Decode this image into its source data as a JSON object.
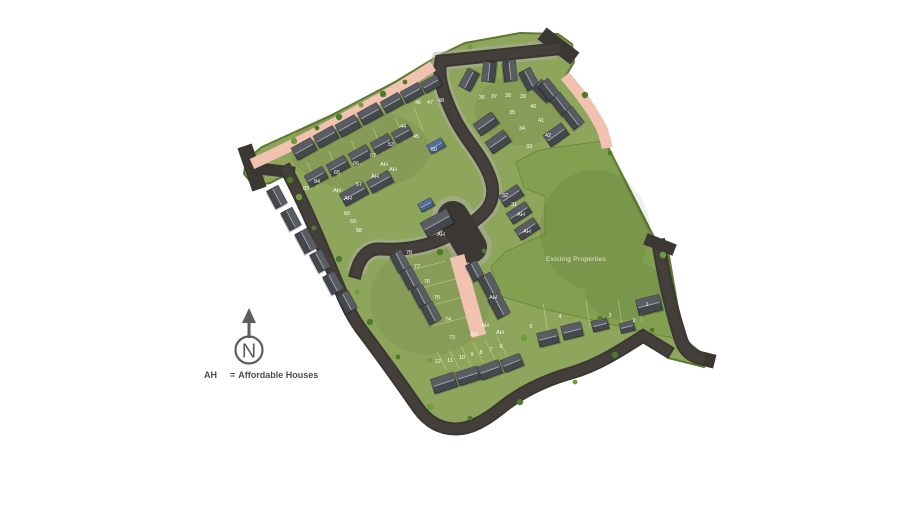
{
  "page": {
    "background": "#ffffff"
  },
  "legend": {
    "ah": "AH",
    "eq": "=",
    "text": "Affordable Houses"
  },
  "compass": {
    "letter": "N"
  },
  "map": {
    "field_label": "Existing Properties",
    "colors": {
      "background": "#ffffff",
      "road": "#3b3733",
      "road_inner": "#443f3a",
      "sidewalk": "#b2afa4",
      "grass": "#8ea55c",
      "field": "#82a050",
      "hedge": "#5d7a33",
      "pink_path": "#f2c2b1",
      "roof": "#44474c",
      "roof_light": "#5d6167",
      "ridge": "#a9aeb4",
      "label_text": "#ffffff",
      "legend_text": "#4c4c4c"
    },
    "plot_labels": [
      {
        "t": "44",
        "x": 403,
        "y": 128
      },
      {
        "t": "45",
        "x": 416,
        "y": 138
      },
      {
        "t": "46",
        "x": 418,
        "y": 104
      },
      {
        "t": "47",
        "x": 430,
        "y": 104
      },
      {
        "t": "48",
        "x": 441,
        "y": 102
      },
      {
        "t": "50",
        "x": 434,
        "y": 151
      },
      {
        "t": "53",
        "x": 391,
        "y": 146
      },
      {
        "t": "67",
        "x": 373,
        "y": 157
      },
      {
        "t": "66",
        "x": 356,
        "y": 165
      },
      {
        "t": "65",
        "x": 337,
        "y": 174
      },
      {
        "t": "84",
        "x": 317,
        "y": 183
      },
      {
        "t": "83",
        "x": 306,
        "y": 190
      },
      {
        "t": "57",
        "x": 359,
        "y": 186
      },
      {
        "t": "AH",
        "x": 384,
        "y": 166
      },
      {
        "t": "AH",
        "x": 393,
        "y": 171
      },
      {
        "t": "AH",
        "x": 375,
        "y": 178
      },
      {
        "t": "AH",
        "x": 337,
        "y": 192
      },
      {
        "t": "AH",
        "x": 348,
        "y": 200
      },
      {
        "t": "60",
        "x": 347,
        "y": 215
      },
      {
        "t": "59",
        "x": 353,
        "y": 223
      },
      {
        "t": "58",
        "x": 359,
        "y": 232
      },
      {
        "t": "AH",
        "x": 441,
        "y": 236
      },
      {
        "t": "78",
        "x": 409,
        "y": 254
      },
      {
        "t": "77",
        "x": 417,
        "y": 268
      },
      {
        "t": "76",
        "x": 427,
        "y": 283
      },
      {
        "t": "75",
        "x": 437,
        "y": 299
      },
      {
        "t": "74",
        "x": 448,
        "y": 321
      },
      {
        "t": "73",
        "x": 452,
        "y": 339
      },
      {
        "t": "AH",
        "x": 474,
        "y": 336
      },
      {
        "t": "AH",
        "x": 493,
        "y": 299
      },
      {
        "t": "AH",
        "x": 485,
        "y": 327
      },
      {
        "t": "AH",
        "x": 500,
        "y": 334
      },
      {
        "t": "36",
        "x": 482,
        "y": 99
      },
      {
        "t": "37",
        "x": 494,
        "y": 98
      },
      {
        "t": "38",
        "x": 508,
        "y": 97
      },
      {
        "t": "39",
        "x": 523,
        "y": 98
      },
      {
        "t": "40",
        "x": 533,
        "y": 108
      },
      {
        "t": "35",
        "x": 512,
        "y": 114
      },
      {
        "t": "41",
        "x": 541,
        "y": 122
      },
      {
        "t": "34",
        "x": 522,
        "y": 130
      },
      {
        "t": "42",
        "x": 548,
        "y": 137
      },
      {
        "t": "33",
        "x": 529,
        "y": 148
      },
      {
        "t": "32",
        "x": 505,
        "y": 197
      },
      {
        "t": "31",
        "x": 514,
        "y": 206
      },
      {
        "t": "AH",
        "x": 521,
        "y": 216
      },
      {
        "t": "AH",
        "x": 527,
        "y": 233
      },
      {
        "t": "12",
        "x": 438,
        "y": 363
      },
      {
        "t": "11",
        "x": 450,
        "y": 362
      },
      {
        "t": "10",
        "x": 462,
        "y": 359
      },
      {
        "t": "9",
        "x": 472,
        "y": 356
      },
      {
        "t": "8",
        "x": 481,
        "y": 354
      },
      {
        "t": "7",
        "x": 491,
        "y": 351
      },
      {
        "t": "6",
        "x": 501,
        "y": 348
      },
      {
        "t": "5",
        "x": 531,
        "y": 328
      },
      {
        "t": "4",
        "x": 560,
        "y": 318
      },
      {
        "t": "3",
        "x": 610,
        "y": 317
      },
      {
        "t": "2",
        "x": 634,
        "y": 322
      },
      {
        "t": "1",
        "x": 647,
        "y": 306
      }
    ]
  }
}
